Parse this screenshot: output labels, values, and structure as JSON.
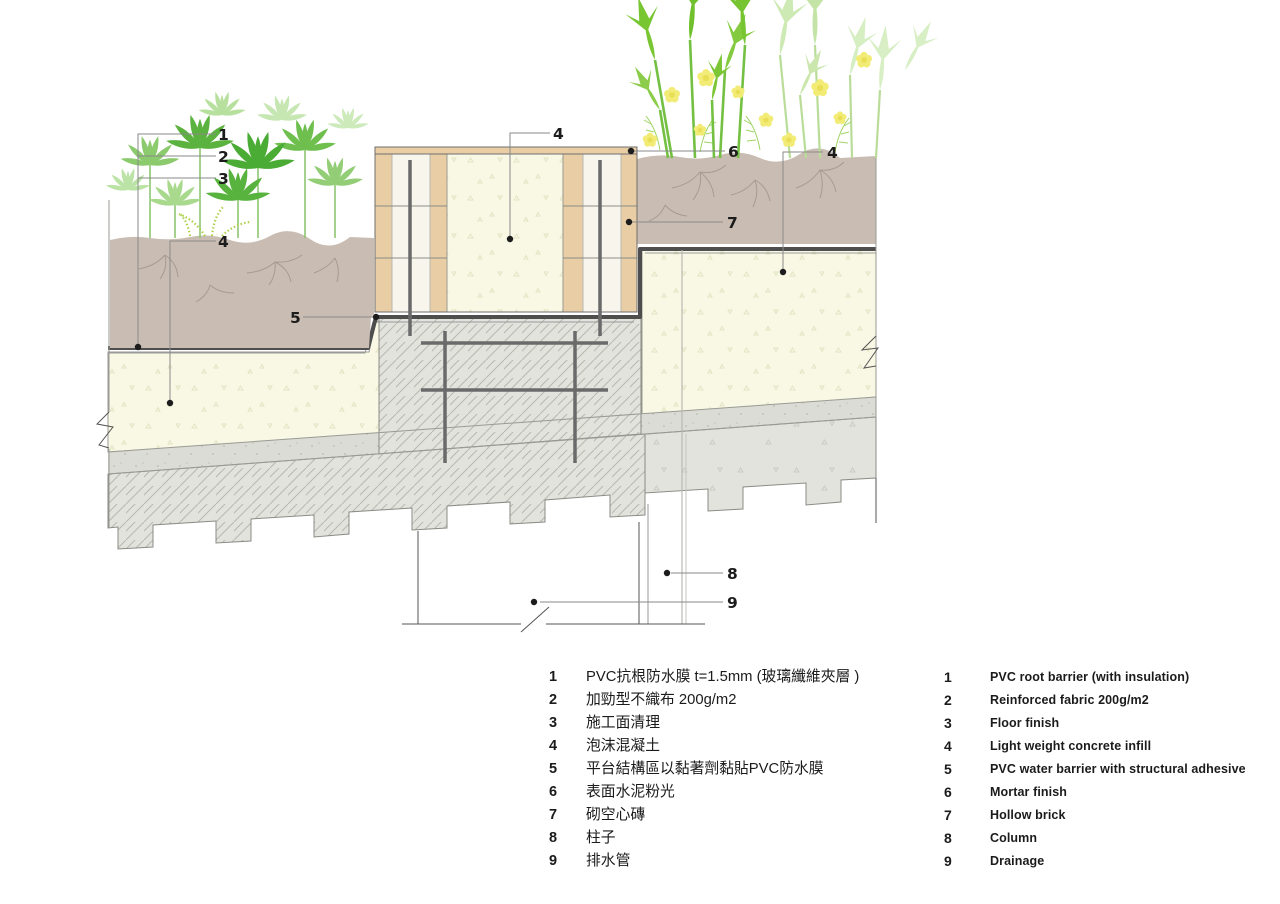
{
  "palette": {
    "soil": "#c9bcb3",
    "soil_root": "#a79a8e",
    "concrete_cream": "#f8f8e5",
    "speckle_cream": "#e3e5c4",
    "brick_tan": "#e8cda5",
    "brick_core": "#f7f5ec",
    "slab_gray": "#e2e3dd",
    "band_gray": "#dbdcd5",
    "hatch_line": "#b7b9b1",
    "membrane": "#4e4e4e",
    "rebar": "#6a6a6a",
    "outline": "#8b8b85",
    "leader": "#8a8a8a",
    "label": "#1c1c1c",
    "leaf_green_dark": "#4aab35",
    "leaf_green": "#6fbf4f",
    "leaf_green_light": "#9ad17f",
    "leaf_pale": "#c6e5b1",
    "plant_bright": "#79c633",
    "plant_pale": "#cde9b4",
    "flower_yellow": "#f2ec77",
    "flower_center": "#e9df57",
    "fern": "#aed14b"
  },
  "drawing": {
    "callouts": [
      {
        "n": "1"
      },
      {
        "n": "2"
      },
      {
        "n": "3"
      },
      {
        "n": "4"
      },
      {
        "n": "5"
      },
      {
        "n": "4"
      },
      {
        "n": "6"
      },
      {
        "n": "4"
      },
      {
        "n": "7"
      },
      {
        "n": "8"
      },
      {
        "n": "9"
      }
    ]
  },
  "legend": {
    "zh": {
      "items": [
        {
          "num": "1",
          "text": "PVC抗根防水膜 t=1.5mm (玻璃纖維夾層 )"
        },
        {
          "num": "2",
          "text": "加勁型不織布 200g/m2"
        },
        {
          "num": "3",
          "text": "施工面清理"
        },
        {
          "num": "4",
          "text": "泡沫混凝土"
        },
        {
          "num": "5",
          "text": "平台結構區以黏著劑黏貼PVC防水膜"
        },
        {
          "num": "6",
          "text": "表面水泥粉光"
        },
        {
          "num": "7",
          "text": "砌空心磚"
        },
        {
          "num": "8",
          "text": "柱子"
        },
        {
          "num": "9",
          "text": "排水管"
        }
      ]
    },
    "en": {
      "items": [
        {
          "num": "1",
          "text": "PVC root barrier (with insulation)"
        },
        {
          "num": "2",
          "text": "Reinforced fabric 200g/m2"
        },
        {
          "num": "3",
          "text": "Floor finish"
        },
        {
          "num": "4",
          "text": "Light weight concrete infill"
        },
        {
          "num": "5",
          "text": "PVC water barrier with structural adhesive"
        },
        {
          "num": "6",
          "text": "Mortar finish"
        },
        {
          "num": "7",
          "text": "Hollow brick"
        },
        {
          "num": "8",
          "text": "Column"
        },
        {
          "num": "9",
          "text": "Drainage"
        }
      ]
    }
  }
}
